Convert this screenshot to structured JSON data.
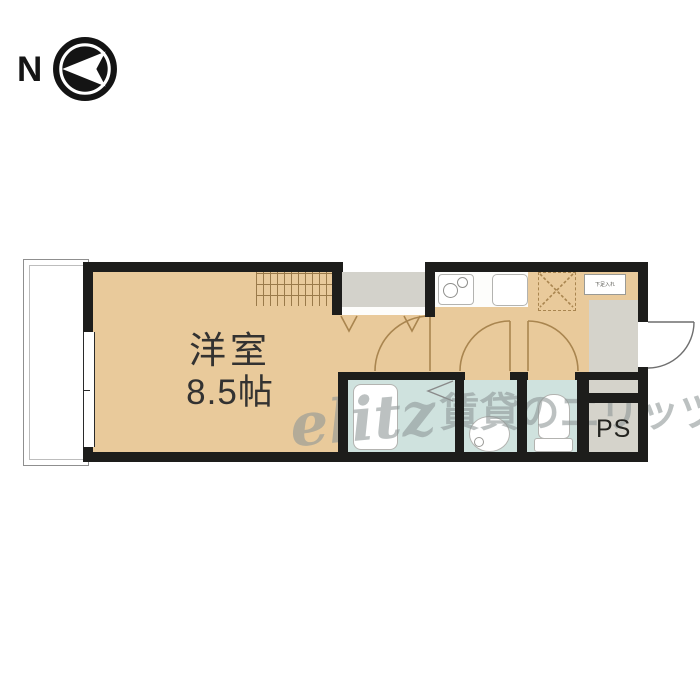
{
  "compass": {
    "label": "N"
  },
  "rooms": {
    "main": {
      "name": "洋室",
      "size": "8.5帖"
    },
    "pipe_shaft_label": "PS",
    "entrance_storage_label": "下足入れ"
  },
  "watermark": {
    "logo": "elitz",
    "text": "賃貸のエリッツ"
  },
  "colors": {
    "floor_tan": "#e9ca9b",
    "wet_area_blue": "#cfe2de",
    "closet_gray": "#d3d2cb",
    "entry_gray": "#d5d3cb",
    "wall_black": "#1d1d1b",
    "door_line_brown": "#a9854f"
  }
}
